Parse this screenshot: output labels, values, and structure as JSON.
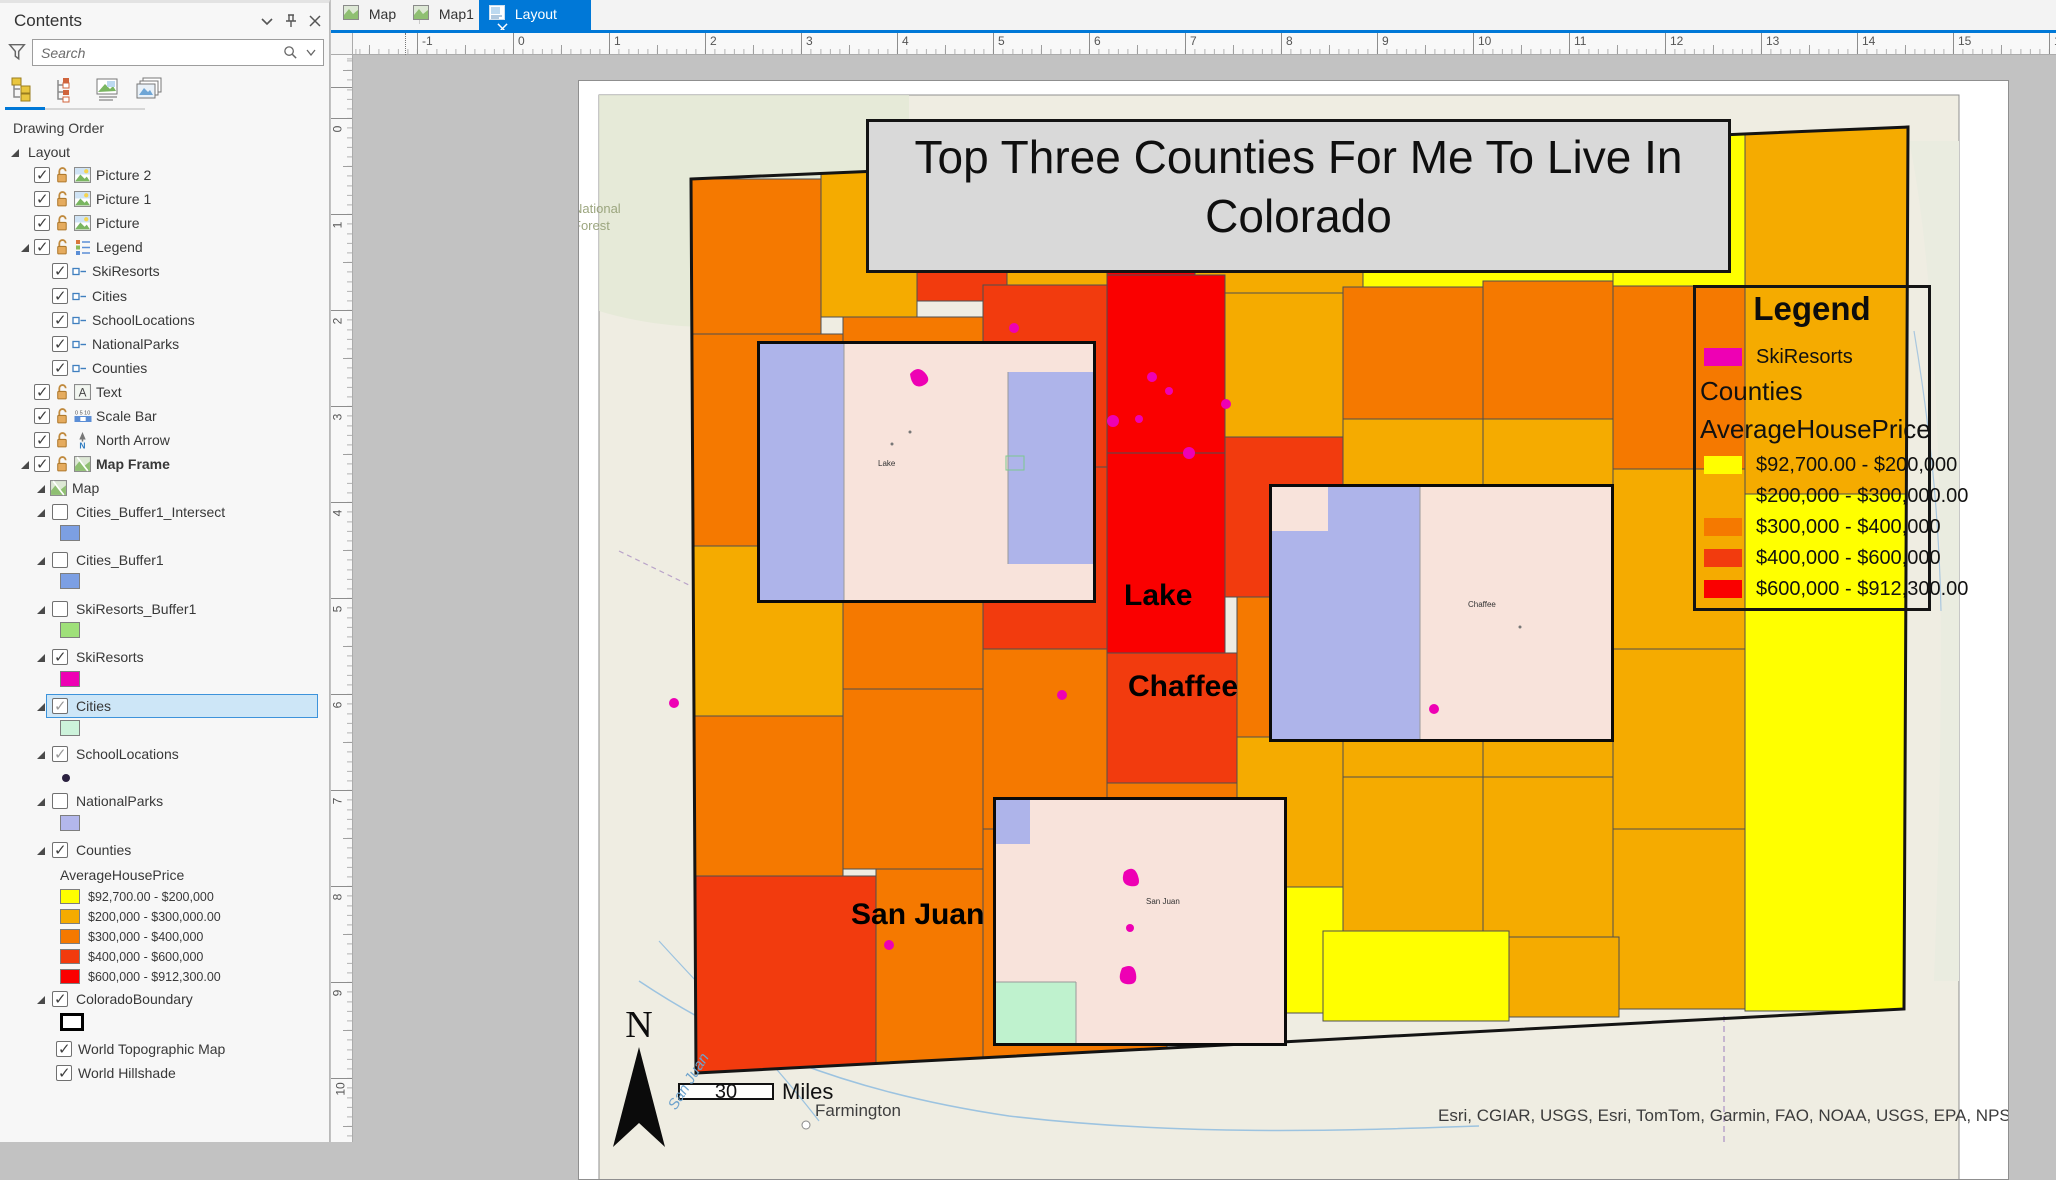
{
  "panel": {
    "title": "Contents",
    "search_placeholder": "Search",
    "drawing_order": "Drawing Order"
  },
  "tabs": {
    "map": "Map",
    "map1": "Map1",
    "layout": "Layout"
  },
  "tree": {
    "layout": "Layout",
    "picture2": "Picture 2",
    "picture1": "Picture 1",
    "picture": "Picture",
    "legend": "Legend",
    "legend_skiresorts": "SkiResorts",
    "legend_cities": "Cities",
    "legend_schoollocations": "SchoolLocations",
    "legend_nationalparks": "NationalParks",
    "legend_counties": "Counties",
    "text": "Text",
    "scale_bar": "Scale Bar",
    "north_arrow": "North Arrow",
    "map_frame": "Map Frame",
    "map": "Map",
    "cities_buffer1_intersect": "Cities_Buffer1_Intersect",
    "cities_buffer1": "Cities_Buffer1",
    "skiresorts_buffer1": "SkiResorts_Buffer1",
    "skiresorts": "SkiResorts",
    "cities": "Cities",
    "schoollocations": "SchoolLocations",
    "nationalparks": "NationalParks",
    "counties": "Counties",
    "avg_house_price": "AverageHousePrice",
    "colorado_boundary": "ColoradoBoundary",
    "world_topographic_map": "World Topographic Map",
    "world_hillshade": "World Hillshade"
  },
  "classes": [
    {
      "label": "$92,700.00 - $200,000",
      "color": "#FFFF00"
    },
    {
      "label": "$200,000 - $300,000.00",
      "color": "#F5AB00"
    },
    {
      "label": "$300,000 - $400,000",
      "color": "#F57900"
    },
    {
      "label": "$400,000 - $600,000",
      "color": "#F23B0E"
    },
    {
      "label": "$600,000 - $912,300.00",
      "color": "#FA0000"
    }
  ],
  "swatches": {
    "buffer_blue": "#7C9FE3",
    "buffer_green": "#9FE07A",
    "skiresorts_magenta": "#EE00B4",
    "cities_mint": "#CDF3DB",
    "nationalparks_lavender": "#B3B7EC",
    "school_dot": "#2B2140",
    "colorado_boundary_outline": "#000000"
  },
  "ui_colors": {
    "active_tab": "#0078D7",
    "selection_fill": "#CDE6F7",
    "selection_border": "#3D93DB"
  },
  "layout_page": {
    "title": "Top Three Counties For Me To Live In Colorado",
    "legend": {
      "title": "Legend",
      "skiresorts": "SkiResorts",
      "counties": "Counties",
      "field": "AverageHousePrice"
    },
    "labels": {
      "lake": "Lake",
      "chaffee": "Chaffee",
      "san_juan": "San Juan"
    },
    "north": "N",
    "scale_value": "30",
    "scale_units": "Miles",
    "city": "Farmington",
    "river": "San Juan",
    "forest": "National Forest",
    "attribution": "Esri, CGIAR, USGS, Esri, TomTom, Garmin, FAO, NOAA, USGS, EPA, NPS, USFWS"
  },
  "rulers": {
    "top": [
      "-1",
      "0",
      "1",
      "2",
      "3",
      "4",
      "5",
      "6",
      "7",
      "8",
      "9",
      "10",
      "11",
      "12",
      "13",
      "14",
      "15",
      "16"
    ],
    "left": [
      "0",
      "1",
      "2",
      "3",
      "4",
      "5",
      "6",
      "7",
      "8",
      "9",
      "10"
    ]
  }
}
